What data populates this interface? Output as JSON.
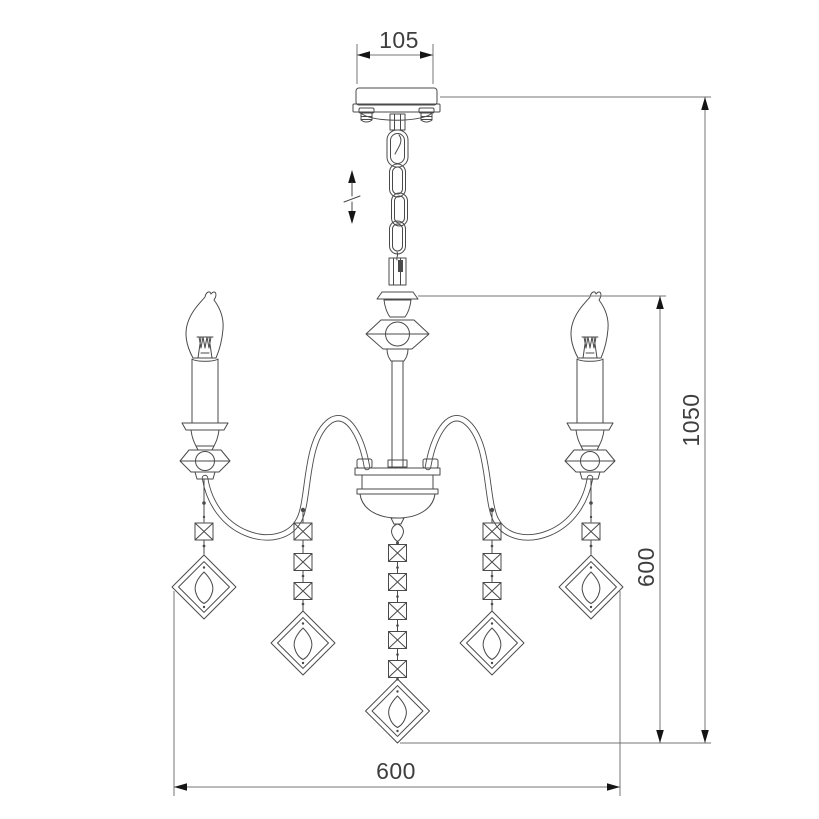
{
  "drawing": {
    "subject": "chandelier-dimension-drawing",
    "line_color": "#4a4a4a",
    "dimension_line_color": "#767676",
    "label_color": "#3e3e3e",
    "arrowhead_color": "#151515",
    "background": "#ffffff"
  },
  "labels": {
    "canopy_width": "105",
    "total_height": "1050",
    "body_drop_height": "600",
    "bottom_diameter": "600"
  },
  "icons": {
    "height_adjust": "vertical-double-arrow"
  }
}
